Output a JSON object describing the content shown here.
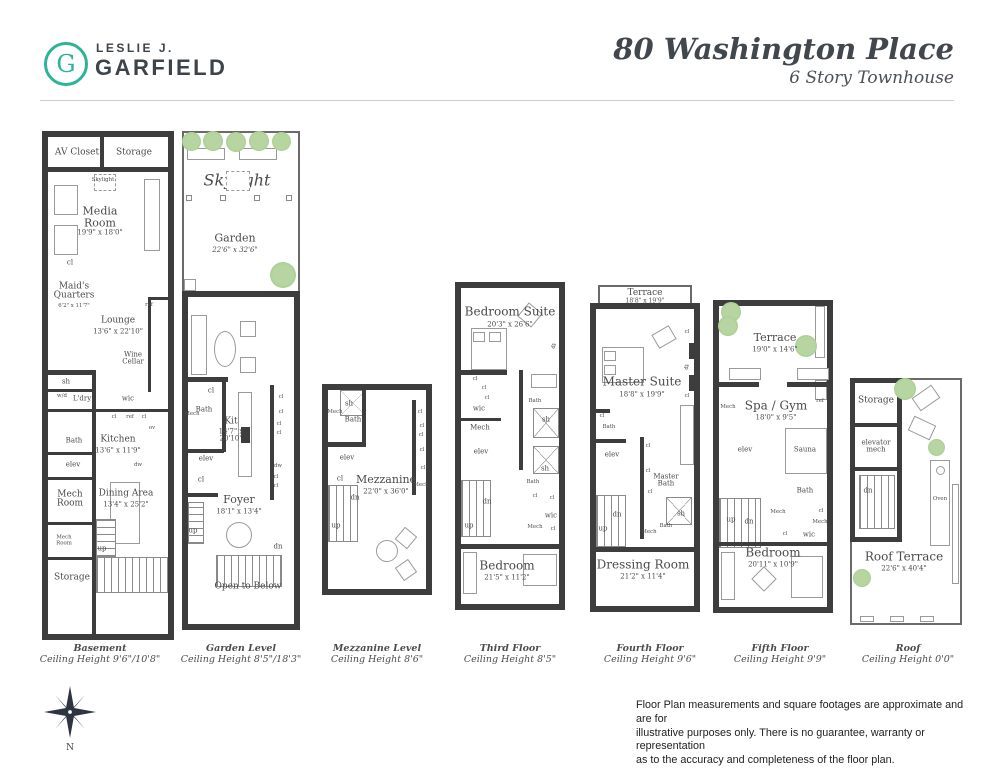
{
  "header": {
    "logo": {
      "letter": "G",
      "line1": "LESLIE J.",
      "line2": "GARFIELD"
    },
    "title": "80 Washington Place",
    "subtitle": "6 Story Townhouse"
  },
  "colors": {
    "accent_green": "#2eb398",
    "tree_green": "#a9cd92",
    "wall": "#3d3d3d"
  },
  "g": {
    "cl": "cl",
    "elev": "elev",
    "up": "up",
    "dn": "dn",
    "sh": "sh",
    "bath": "Bath",
    "mech": "Mech",
    "wic": "wic",
    "ref": "ref",
    "dw": "dw",
    "ov": "ov",
    "wd": "w/d",
    "ldry": "L'dry",
    "fp": "fp",
    "skylight": "Skylight",
    "open_to_below": "Open to Below",
    "oven": "Oven",
    "sauna": "Sauna",
    "n": "N"
  },
  "plans": {
    "basement": {
      "caption": "Basement",
      "ceiling": "Ceiling Height 9'6\"/10'8\"",
      "rooms": {
        "av_closet": {
          "name": "AV Closet"
        },
        "storage_top": {
          "name": "Storage"
        },
        "media_room": {
          "name": "Media Room",
          "dims": "19'9\" x 18'0\""
        },
        "maids_quarters": {
          "name": "Maid's Quarters",
          "dims": "6'2\" x 11'7\""
        },
        "lounge": {
          "name": "Lounge",
          "dims": "13'6\" x 22'10\""
        },
        "wine_cellar": {
          "name": "Wine Cellar"
        },
        "kitchen": {
          "name": "Kitchen",
          "dims": "13'6\" x 11'9\""
        },
        "dining_area": {
          "name": "Dining Area",
          "dims": "13'4\" x 25'2\""
        },
        "mech_room": {
          "name": "Mech Room"
        },
        "mech_room_small": {
          "name": "Mech Room"
        },
        "storage_bottom": {
          "name": "Storage"
        }
      }
    },
    "garden": {
      "caption": "Garden Level",
      "ceiling": "Ceiling Height 8'5\"/18'3\"",
      "rooms": {
        "garden": {
          "name": "Garden",
          "dims": "22'6\" x 32'6\""
        },
        "living_room": {
          "name": "Living Room",
          "dims": "20'3\" x 20'4\""
        },
        "kit": {
          "name": "Kit",
          "dims": "14'7\" x 20'10\""
        },
        "foyer": {
          "name": "Foyer",
          "dims": "18'1\" x 13'4\""
        }
      }
    },
    "mezzanine": {
      "caption": "Mezzanine Level",
      "ceiling": "Ceiling Height 8'6\"",
      "rooms": {
        "mezzanine": {
          "name": "Mezzanine",
          "dims": "22'0\" x 36'0\""
        }
      }
    },
    "third": {
      "caption": "Third Floor",
      "ceiling": "Ceiling Height 8'5\"",
      "rooms": {
        "bedroom_suite": {
          "name": "Bedroom Suite",
          "dims": "20'3\" x 26'6\""
        },
        "bedroom": {
          "name": "Bedroom",
          "dims": "21'5\" x 11'2\""
        }
      }
    },
    "fourth": {
      "caption": "Fourth Floor",
      "ceiling": "Ceiling Height 9'6\"",
      "rooms": {
        "terrace": {
          "name": "Terrace",
          "dims": "18'8\" x 19'9\""
        },
        "master_suite": {
          "name": "Master Suite",
          "dims": "18'8\" x 19'9\""
        },
        "master_bath": {
          "name": "Master Bath"
        },
        "dressing_room": {
          "name": "Dressing Room",
          "dims": "21'2\" x 11'4\""
        }
      }
    },
    "fifth": {
      "caption": "Fifth Floor",
      "ceiling": "Ceiling Height 9'9\"",
      "rooms": {
        "terrace": {
          "name": "Terrace",
          "dims": "19'0\" x 14'6\""
        },
        "spa_gym": {
          "name": "Spa / Gym",
          "dims": "18'0\" x 9'5\""
        },
        "bedroom": {
          "name": "Bedroom",
          "dims": "20'11\" x 10'9\""
        }
      }
    },
    "roof": {
      "caption": "Roof",
      "ceiling": "Ceiling Height 0'0\"",
      "rooms": {
        "storage": {
          "name": "Storage"
        },
        "elevator_mech": {
          "name": "elevator mech"
        },
        "roof_terrace": {
          "name": "Roof Terrace",
          "dims": "22'6\" x 40'4\""
        }
      }
    }
  },
  "footer": {
    "disclaimer_line1": "Floor Plan measurements and square footages are approximate and are for",
    "disclaimer_line2": "illustrative purposes only. There is no guarantee, warranty or representation",
    "disclaimer_line3": "as to the accuracy and completeness of the floor plan."
  }
}
